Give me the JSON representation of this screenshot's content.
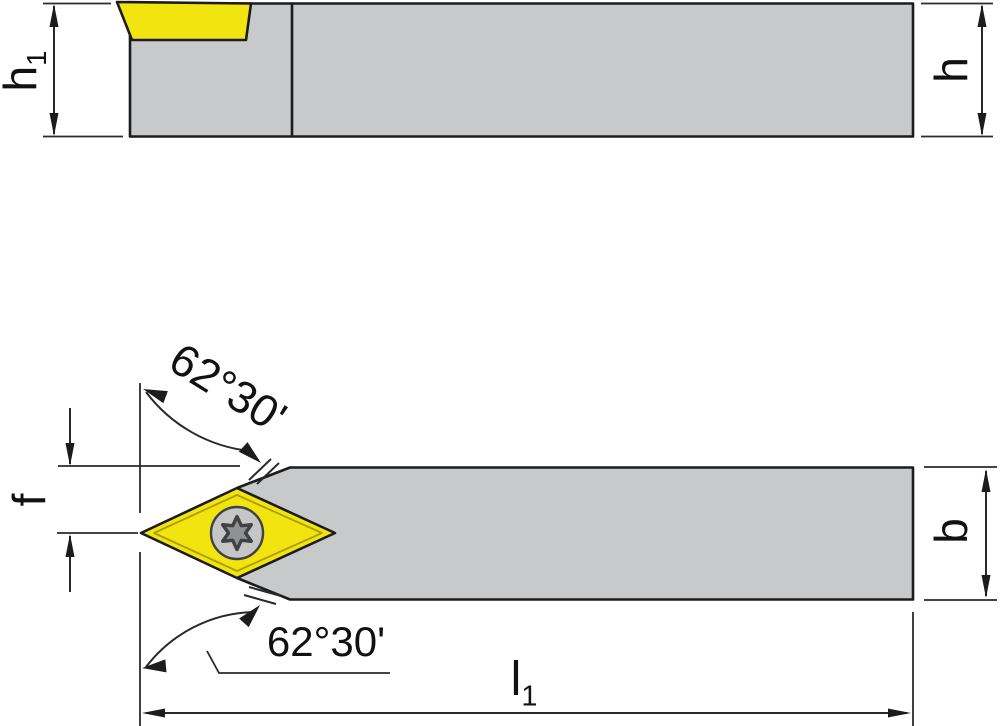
{
  "dimensions": {
    "h1": {
      "main": "h",
      "sub": "1"
    },
    "h": {
      "main": "h"
    },
    "f": {
      "main": "f"
    },
    "b": {
      "main": "b"
    },
    "l1": {
      "main": "l",
      "sub": "1"
    },
    "angle_top": "62°30'",
    "angle_bottom": "62°30'"
  },
  "colors": {
    "steel_gray": "#c8c9cb",
    "insert_yellow": "#f2e40e",
    "insert_border_olive": "#ab9e05",
    "screw_head_gray": "#c6c6c6",
    "torx_star_gray": "#8f9193",
    "outline_black": "#1c1c1c"
  }
}
